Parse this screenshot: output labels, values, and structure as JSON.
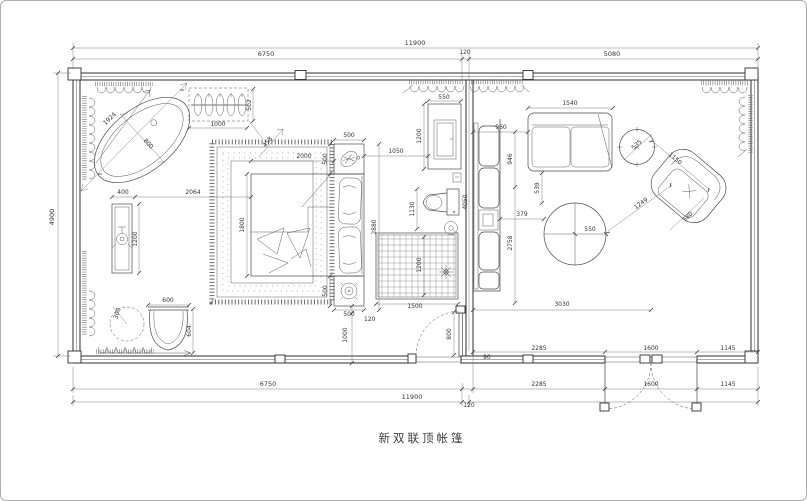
{
  "caption": "新双联顶帐篷",
  "colors": {
    "background": "#ffffff",
    "wall_line": "#2e2e2e",
    "furniture_line": "#4a4a4a",
    "dimension_line": "#707070",
    "dimension_text": "#333333",
    "canvas_border": "#adadad"
  },
  "dims": {
    "top_overall": "11900",
    "top_left": "6750",
    "top_mid": "120",
    "top_right": "5080",
    "left_height": "4900",
    "bottom_upper_2285": "2285",
    "bottom_upper_1600": "1600",
    "bottom_upper_1145": "1145",
    "bottom_6750": "6750",
    "bottom_2285": "2285",
    "bottom_1600": "1600",
    "bottom_1145": "1145",
    "bottom_overall": "11900",
    "bottom_wall": "120",
    "tub_length": "1924",
    "tub_width": "800",
    "rack_width": "1000",
    "rack_depth": "502",
    "vanity_width": "400",
    "vanity_to_bed": "2064",
    "vanity_length": "1200",
    "stool_radius": "300",
    "chair_width": "600",
    "chair_depth": "604",
    "rug_gap": "458",
    "bed_width": "2000",
    "bed_length": "1800",
    "nightstand_top_w": "500",
    "nightstand_top_d": "500",
    "nightstand_bot_d": "500",
    "nightstand_bot_w": "500",
    "bed_wall_gap": "120",
    "bed_foot_gap": "1000",
    "bed_zone": "2880",
    "shower_width": "1500",
    "shower_depth": "1200",
    "cabinet_width": "550",
    "cabinet_height": "1200",
    "cabinet_gap": "1050",
    "toilet_width": "1130",
    "door_width": "800",
    "door_jamb": "90",
    "sofa_length": "4050",
    "couch_offset": "960",
    "couch_width": "1540",
    "couch_depth": "946",
    "living_depth": "2758",
    "table_gap_v": "539",
    "table_gap_h": "379",
    "table_radius": "550",
    "side_table": "535",
    "armchair_width": "1150",
    "armchair_gap": "1249",
    "armchair_depth": "580",
    "living_width": "3030"
  }
}
